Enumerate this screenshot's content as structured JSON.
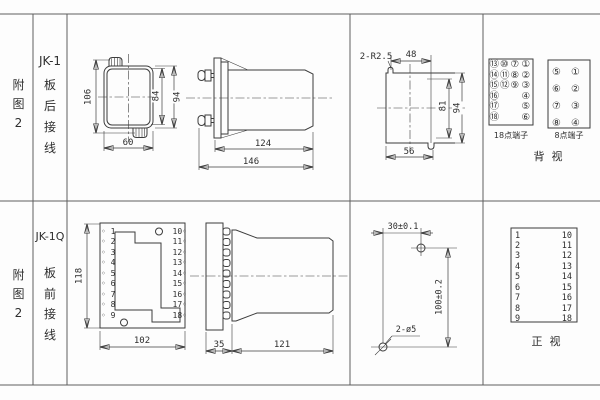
{
  "row1": {
    "fig_label": "附\n图\n2",
    "model": "JK-1",
    "mount_label": "板\n后\n接\n线",
    "front_view": {
      "height": "106",
      "inner_height": "84",
      "outer_height": "94",
      "width": "60"
    },
    "side_view": {
      "body_depth": "124",
      "total_depth": "146"
    },
    "cutout": {
      "slot_label": "2-R2.5",
      "slot_spacing": "48",
      "inner_height": "81",
      "height": "94",
      "width": "56"
    },
    "rear_view": {
      "block18": {
        "col1": "⑬\n⑭\n⑮\n⑯\n⑰\n⑱",
        "col2": "⑩\n⑪\n⑫",
        "col3": "⑦\n⑧\n⑨",
        "col4": "①\n②\n③\n④\n⑤\n⑥",
        "label": "18点端子"
      },
      "block8": {
        "col1": "⑤\n⑥\n⑦\n⑧",
        "col2": "①\n②\n③\n④",
        "label": "8点端子"
      },
      "title": "背  视"
    }
  },
  "row2": {
    "fig_label": "附\n图\n2",
    "model": "JK-1Q",
    "mount_label": "板\n前\n接\n线",
    "front_view": {
      "height": "118",
      "width": "102",
      "left_terminals": "◦ 1\n◦ 2\n◦ 3\n◦ 4\n◦ 5\n◦ 6\n◦ 7\n◦ 8\n◦ 9",
      "right_terminals": "10◦\n11◦\n12◦\n13◦\n14◦\n15◦\n16◦\n17◦\n18◦"
    },
    "side_view": {
      "plate_depth": "35",
      "body_depth": "121"
    },
    "drill": {
      "hole_spacing_x": "30±0.1",
      "hole_spacing_y": "100±0.2",
      "hole_label": "2-ø5"
    },
    "front_table": {
      "left": "1\n2\n3\n4\n5\n6\n7\n8\n9",
      "right": "10\n11\n12\n13\n14\n15\n16\n17\n18",
      "title": "正  视"
    }
  }
}
